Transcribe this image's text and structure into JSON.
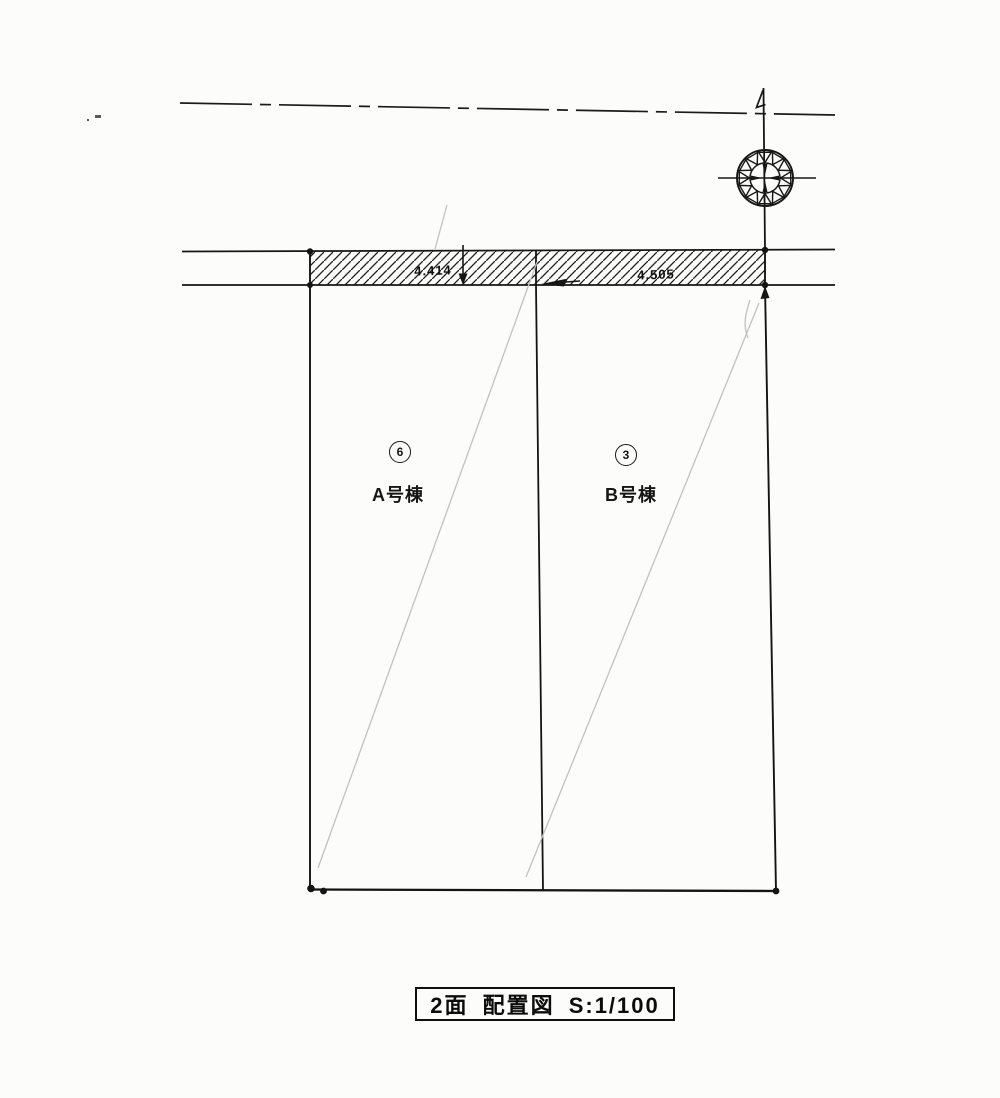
{
  "drawing": {
    "title_caption": "2面 配置図 S:1/100",
    "sheet_no": "2面",
    "title": "配置図",
    "scale": "S:1/100"
  },
  "plots": [
    {
      "lot_number": "6",
      "label": "A号棟"
    },
    {
      "lot_number": "3",
      "label": "B号棟"
    }
  ],
  "dimensions": [
    {
      "value": "4.414"
    },
    {
      "value": "4.505"
    }
  ],
  "symbols": {
    "north": "compass-rosette-icon"
  },
  "colors": {
    "paper": "#fcfcfa",
    "ink": "#161616",
    "faint_pencil": "#c2c2ba"
  }
}
